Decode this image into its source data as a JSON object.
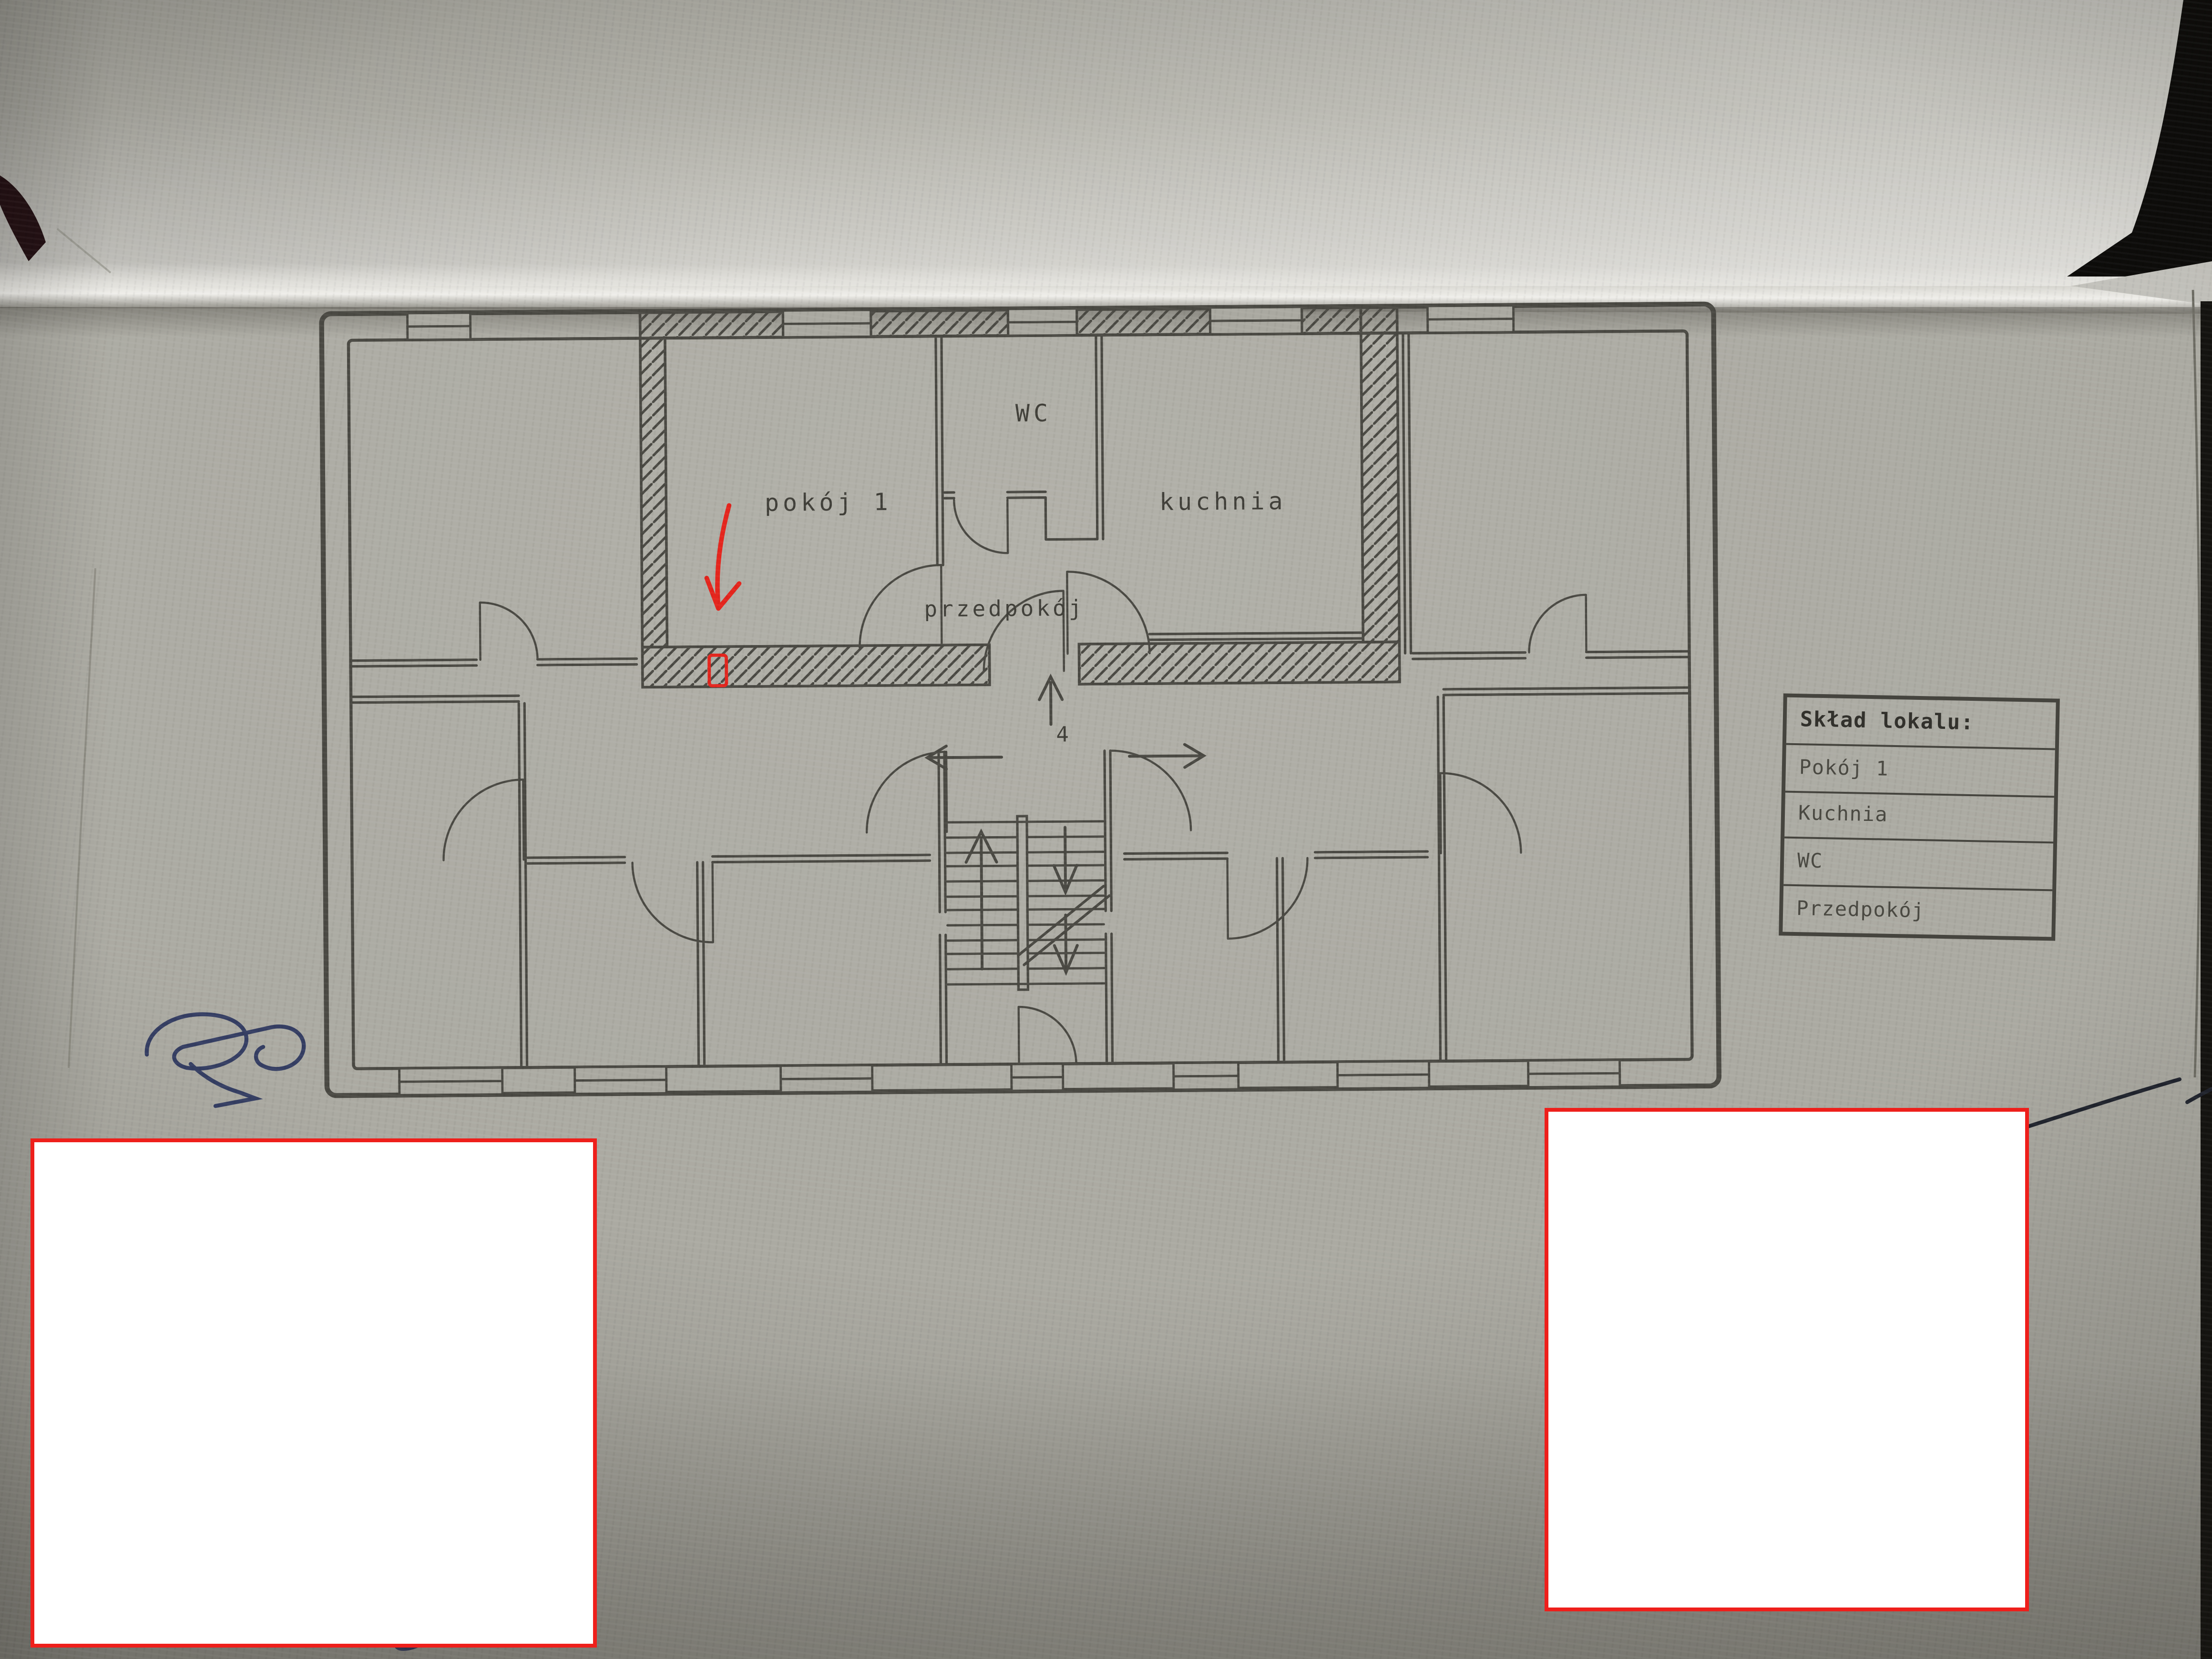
{
  "plan": {
    "rooms": [
      {
        "label": "pokój 1"
      },
      {
        "label": "WC"
      },
      {
        "label": "kuchnia"
      },
      {
        "label": "przedpokój"
      }
    ],
    "stair_flight_number": "4"
  },
  "legend": {
    "title": "Skład lokalu:",
    "items": [
      "Pokój 1",
      "Kuchnia",
      "WC",
      "Przedpokój"
    ]
  },
  "colors": {
    "annotation_red": "#e4251d",
    "redaction_border": "#ee1f1b",
    "ink_blue": "#353e63",
    "plan_line": "#4a4943",
    "paper": "#aaa9a1"
  }
}
